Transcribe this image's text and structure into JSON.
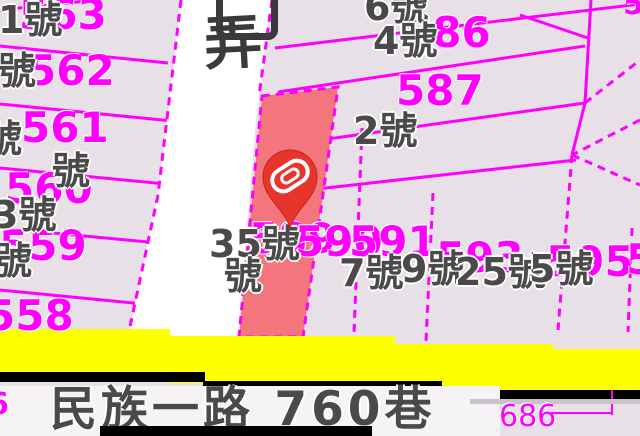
{
  "title": "cadastral parcel map",
  "colors": {
    "background": "#e7e1e7",
    "parcel_line": "#ff00ff",
    "parcel_text": "#ff00ff",
    "house_text": "#4a4a4a",
    "halo": "#ffffff",
    "road_fill": "#ffffff",
    "highlight_fill": "#f2767b",
    "pin_fill": "#e7342c",
    "pin_glyph": "#ffffff",
    "yellow_road": "#ffff00",
    "casing": "#000000",
    "street_text": "#4a4a4a",
    "lane_text": "#3a3a3a"
  },
  "labels": {
    "street_name": "民族一路 760巷",
    "street_pos": {
      "x": 50,
      "y": 386
    },
    "lane_name": "弄",
    "lane_pos": {
      "x": 204,
      "y": 14
    },
    "parcel_numbers": [
      {
        "text": "563",
        "x": 19,
        "y": -6
      },
      {
        "text": "562",
        "x": 27,
        "y": 50
      },
      {
        "text": "561",
        "x": 21,
        "y": 107
      },
      {
        "text": "560",
        "x": 5,
        "y": 168
      },
      {
        "text": "559",
        "x": -1,
        "y": 225
      },
      {
        "text": "558",
        "x": -14,
        "y": 295
      },
      {
        "text": "586",
        "x": 403,
        "y": 12
      },
      {
        "text": "587",
        "x": 396,
        "y": 70
      },
      {
        "text": "589",
        "x": 249,
        "y": 218
      },
      {
        "text": "590",
        "x": 295,
        "y": 221
      },
      {
        "text": "591",
        "x": 349,
        "y": 221
      },
      {
        "text": "593",
        "x": 436,
        "y": 237
      },
      {
        "text": "595",
        "x": 546,
        "y": 241
      },
      {
        "text": "5",
        "x": 626,
        "y": 239
      },
      {
        "text": "5",
        "x": 623,
        "y": -10,
        "size": 30
      },
      {
        "text": "6",
        "x": -12,
        "y": 390,
        "size": 30
      },
      {
        "text": "686",
        "x": 499,
        "y": 402,
        "size": 30,
        "weight": "normal"
      }
    ],
    "house_numbers": [
      {
        "text": "1號",
        "x": -2,
        "y": 1
      },
      {
        "text": "號",
        "x": -2,
        "y": 52
      },
      {
        "text": "號",
        "x": -16,
        "y": 120
      },
      {
        "text": "號",
        "x": 52,
        "y": 152
      },
      {
        "text": "3號",
        "x": -8,
        "y": 196
      },
      {
        "text": "號",
        "x": -6,
        "y": 242
      },
      {
        "text": "6號",
        "x": 364,
        "y": -12
      },
      {
        "text": "4號",
        "x": 373,
        "y": 22
      },
      {
        "text": "2號",
        "x": 353,
        "y": 112
      },
      {
        "text": "35號",
        "x": 209,
        "y": 225
      },
      {
        "text": "號",
        "x": 224,
        "y": 257
      },
      {
        "text": "7號",
        "x": 339,
        "y": 254
      },
      {
        "text": "9號",
        "x": 401,
        "y": 250
      },
      {
        "text": "25號",
        "x": 455,
        "y": 253
      },
      {
        "text": "5號",
        "x": 529,
        "y": 250
      }
    ]
  },
  "geometry": {
    "white_road": [
      [
        181,
        0
      ],
      [
        272,
        0
      ],
      [
        256,
        120
      ],
      [
        238,
        336
      ],
      [
        128,
        336
      ],
      [
        158,
        195
      ]
    ],
    "highlight_parcel": [
      [
        262,
        96
      ],
      [
        338,
        87
      ],
      [
        303,
        337
      ],
      [
        239,
        337
      ]
    ],
    "solid_lines": [
      [
        0,
        10,
        96,
        0
      ],
      [
        0,
        46,
        168,
        63
      ],
      [
        0,
        104,
        172,
        121
      ],
      [
        0,
        168,
        176,
        185
      ],
      [
        0,
        228,
        180,
        245
      ],
      [
        0,
        290,
        184,
        308
      ],
      [
        275,
        48,
        640,
        4
      ],
      [
        278,
        92,
        585,
        46
      ],
      [
        285,
        145,
        585,
        103
      ],
      [
        290,
        192,
        576,
        160
      ],
      [
        591,
        0,
        585,
        103
      ],
      [
        520,
        15,
        588,
        38
      ],
      [
        585,
        103,
        572,
        155
      ]
    ],
    "dashed_lines": [
      [
        181,
        0,
        158,
        195
      ],
      [
        158,
        195,
        128,
        336
      ],
      [
        272,
        0,
        259,
        96
      ],
      [
        585,
        103,
        640,
        60
      ],
      [
        640,
        120,
        572,
        155
      ],
      [
        572,
        155,
        640,
        185
      ],
      [
        572,
        155,
        558,
        330
      ],
      [
        433,
        193,
        426,
        341
      ],
      [
        362,
        128,
        354,
        334
      ],
      [
        632,
        228,
        628,
        332
      ],
      [
        443,
        383,
        405,
        436
      ]
    ],
    "leader_lines": [
      [
        612,
        390,
        612,
        415
      ],
      [
        545,
        413,
        612,
        413
      ]
    ],
    "yellow_segments": [
      [
        0,
        329,
        170,
        45
      ],
      [
        168,
        336,
        227,
        47
      ],
      [
        393,
        344,
        160,
        47
      ],
      [
        551,
        349,
        89,
        42
      ]
    ],
    "casing_segments": [
      [
        0,
        372,
        205,
        10
      ],
      [
        203,
        381,
        239,
        10
      ],
      [
        440,
        390,
        200,
        10
      ]
    ],
    "bottom_bar": [
      100,
      426,
      272,
      10
    ],
    "street_surface": [
      0,
      386,
      500,
      50
    ],
    "gray_streak": [
      470,
      399,
      170,
      5
    ],
    "cut_glyph_box": {
      "x": 216,
      "y": -16,
      "w": 48,
      "h": 42
    }
  }
}
